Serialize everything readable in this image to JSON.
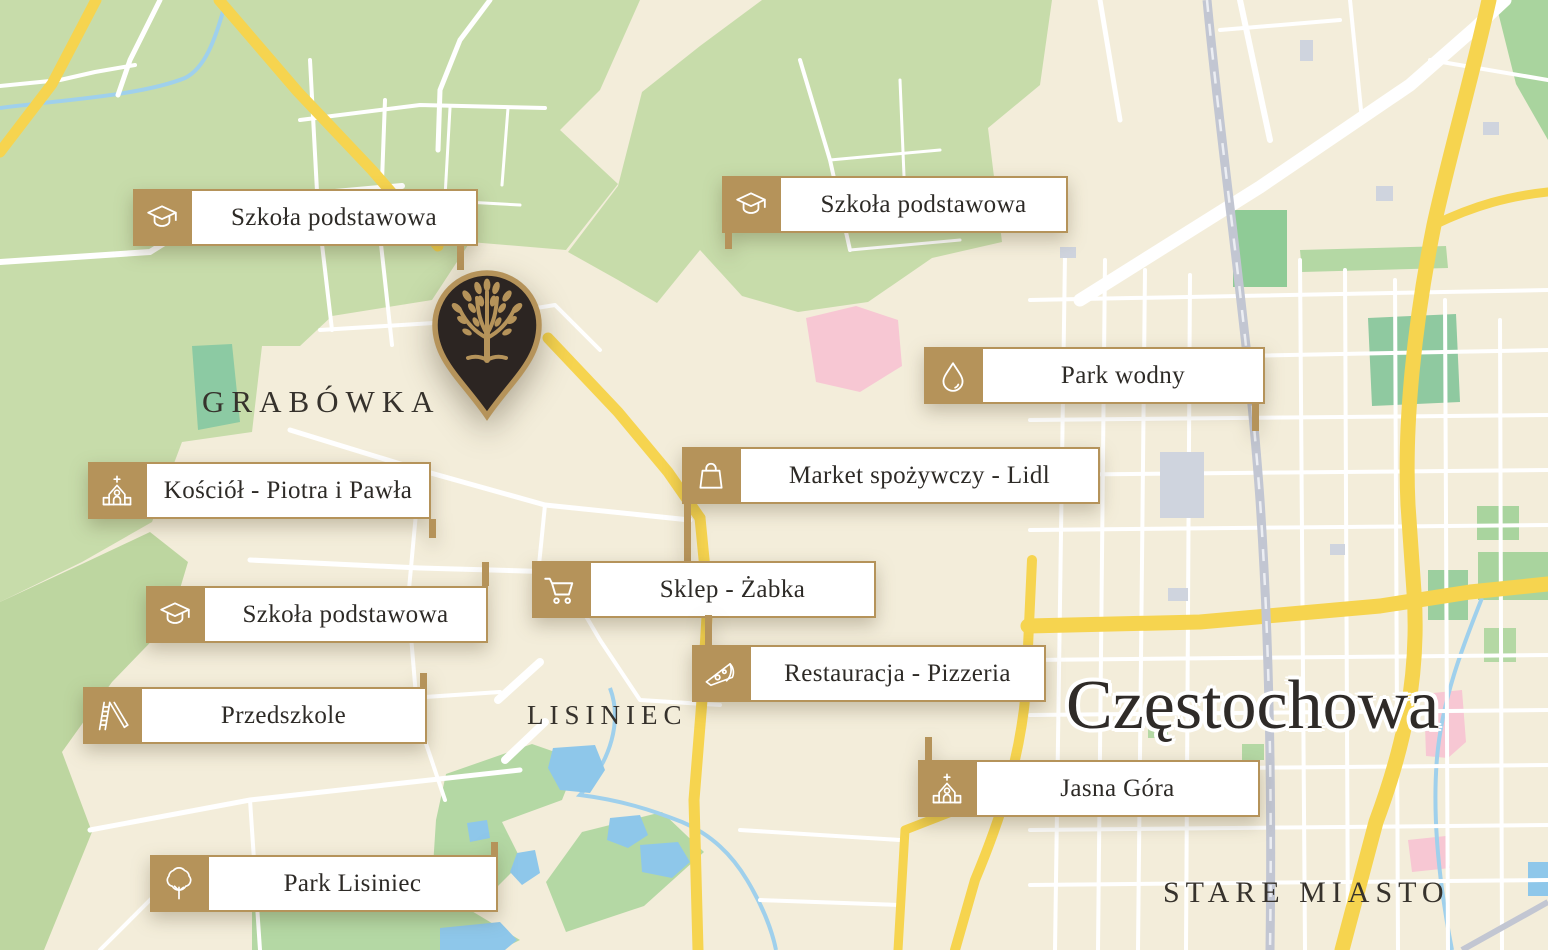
{
  "map": {
    "city_label": "Częstochowa",
    "districts": {
      "grabowka": "GRABÓWKA",
      "lisiniec": "LISINIEC",
      "stare_miasto": "STARE MIASTO"
    }
  },
  "pois": [
    {
      "id": "school-1",
      "label": "Szkoła podstawowa",
      "icon": "graduation-cap-icon"
    },
    {
      "id": "school-2",
      "label": "Szkoła podstawowa",
      "icon": "graduation-cap-icon"
    },
    {
      "id": "water-park",
      "label": "Park wodny",
      "icon": "water-drop-icon"
    },
    {
      "id": "grocery-lidl",
      "label": "Market spożywczy - Lidl",
      "icon": "shopping-bag-icon"
    },
    {
      "id": "church-peter-paul",
      "label": "Kościół - Piotra i Pawła",
      "icon": "church-icon"
    },
    {
      "id": "shop-zabka",
      "label": "Sklep - Żabka",
      "icon": "shopping-cart-icon"
    },
    {
      "id": "school-3",
      "label": "Szkoła podstawowa",
      "icon": "graduation-cap-icon"
    },
    {
      "id": "restaurant-pizzeria",
      "label": "Restauracja - Pizzeria",
      "icon": "pizza-slice-icon"
    },
    {
      "id": "kindergarten",
      "label": "Przedszkole",
      "icon": "playground-slide-icon"
    },
    {
      "id": "jasna-gora",
      "label": "Jasna Góra",
      "icon": "church-icon"
    },
    {
      "id": "park-lisiniec",
      "label": "Park Lisiniec",
      "icon": "tree-icon"
    }
  ],
  "pin": {
    "icon": "tree-logo-icon"
  },
  "colors": {
    "gold": "#b5935a",
    "pin_dark": "#2c2522",
    "map_cream": "#f3edda",
    "forest_green": "#c7dcaa",
    "water_blue": "#8ec7ea",
    "road_yellow": "#f6d44f",
    "road_white": "#ffffff",
    "railway_gray": "#c2c6d2",
    "zone_pink": "#f7c7d3"
  }
}
